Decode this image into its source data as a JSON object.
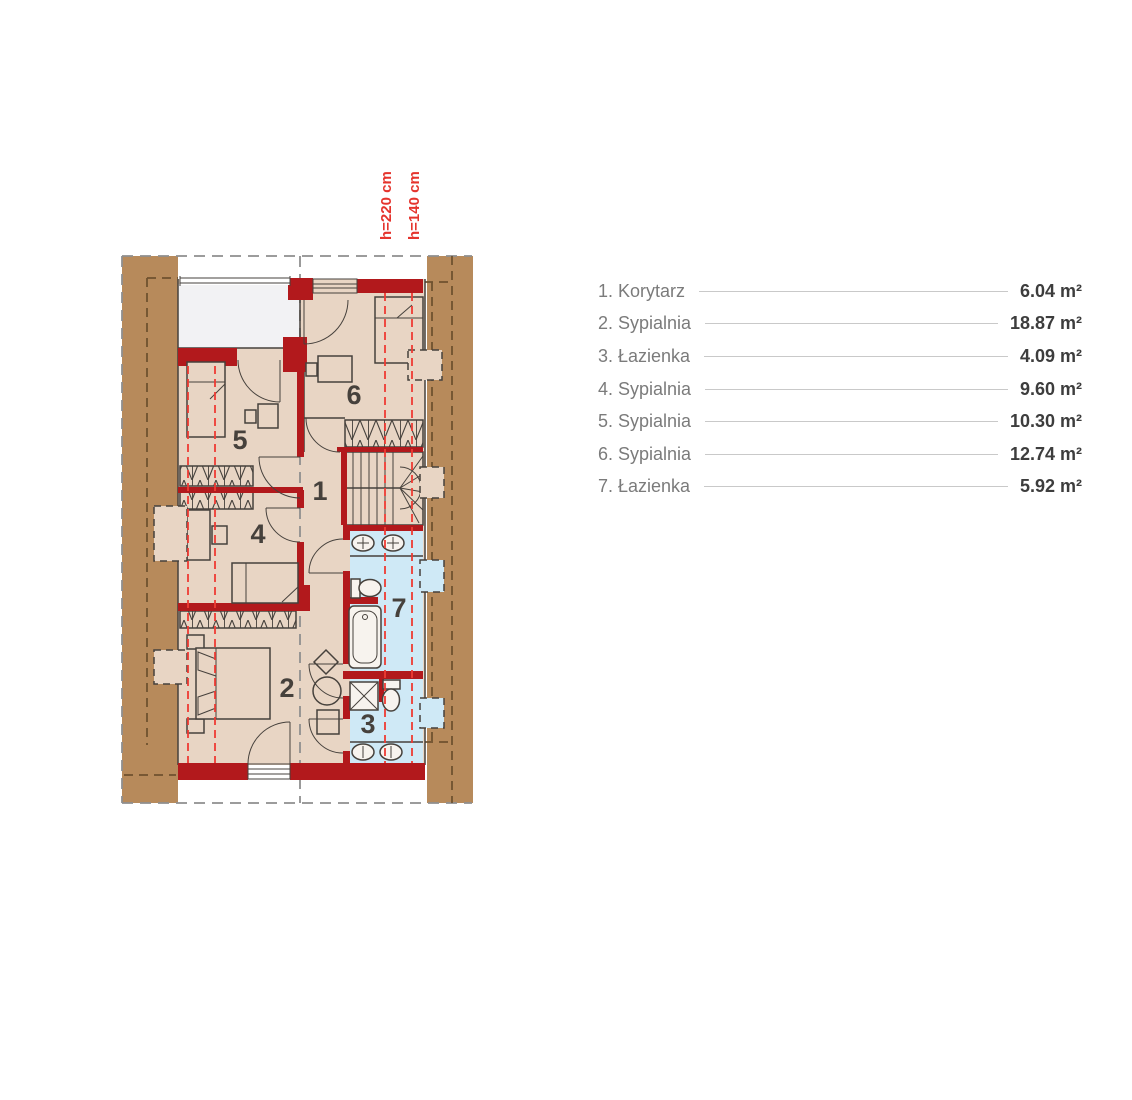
{
  "plan": {
    "height_labels": [
      "h=220 cm",
      "h=140 cm"
    ],
    "room_numbers": [
      "1",
      "2",
      "3",
      "4",
      "5",
      "6",
      "7"
    ]
  },
  "legend": {
    "items": [
      {
        "label": "1. Korytarz",
        "area": "6.04 m²"
      },
      {
        "label": "2. Sypialnia",
        "area": "18.87 m²"
      },
      {
        "label": "3. Łazienka",
        "area": "4.09 m²"
      },
      {
        "label": "4. Sypialnia",
        "area": "9.60 m²"
      },
      {
        "label": "5. Sypialnia",
        "area": "10.30 m²"
      },
      {
        "label": "6. Sypialnia",
        "area": "12.74 m²"
      },
      {
        "label": "7. Łazienka",
        "area": "5.92 m²"
      }
    ]
  },
  "colors": {
    "wall-red": "#b2191c",
    "roof-brown": "#b78a5b",
    "floor-tan": "#e8d5c4",
    "bath-blue": "#cfe9f6",
    "void-white": "#f2f2f4",
    "line-dark": "#46413c",
    "dash-red": "#ee3b33",
    "dash-gray": "#8f8f8f",
    "dash-brown": "#6f522f",
    "fixture-white": "#f7f3ee",
    "legend-name": "#7b7b7b",
    "legend-value": "#3d3d3d",
    "legend-line": "#c9c9c9",
    "hlabel-red": "#e5342d"
  }
}
